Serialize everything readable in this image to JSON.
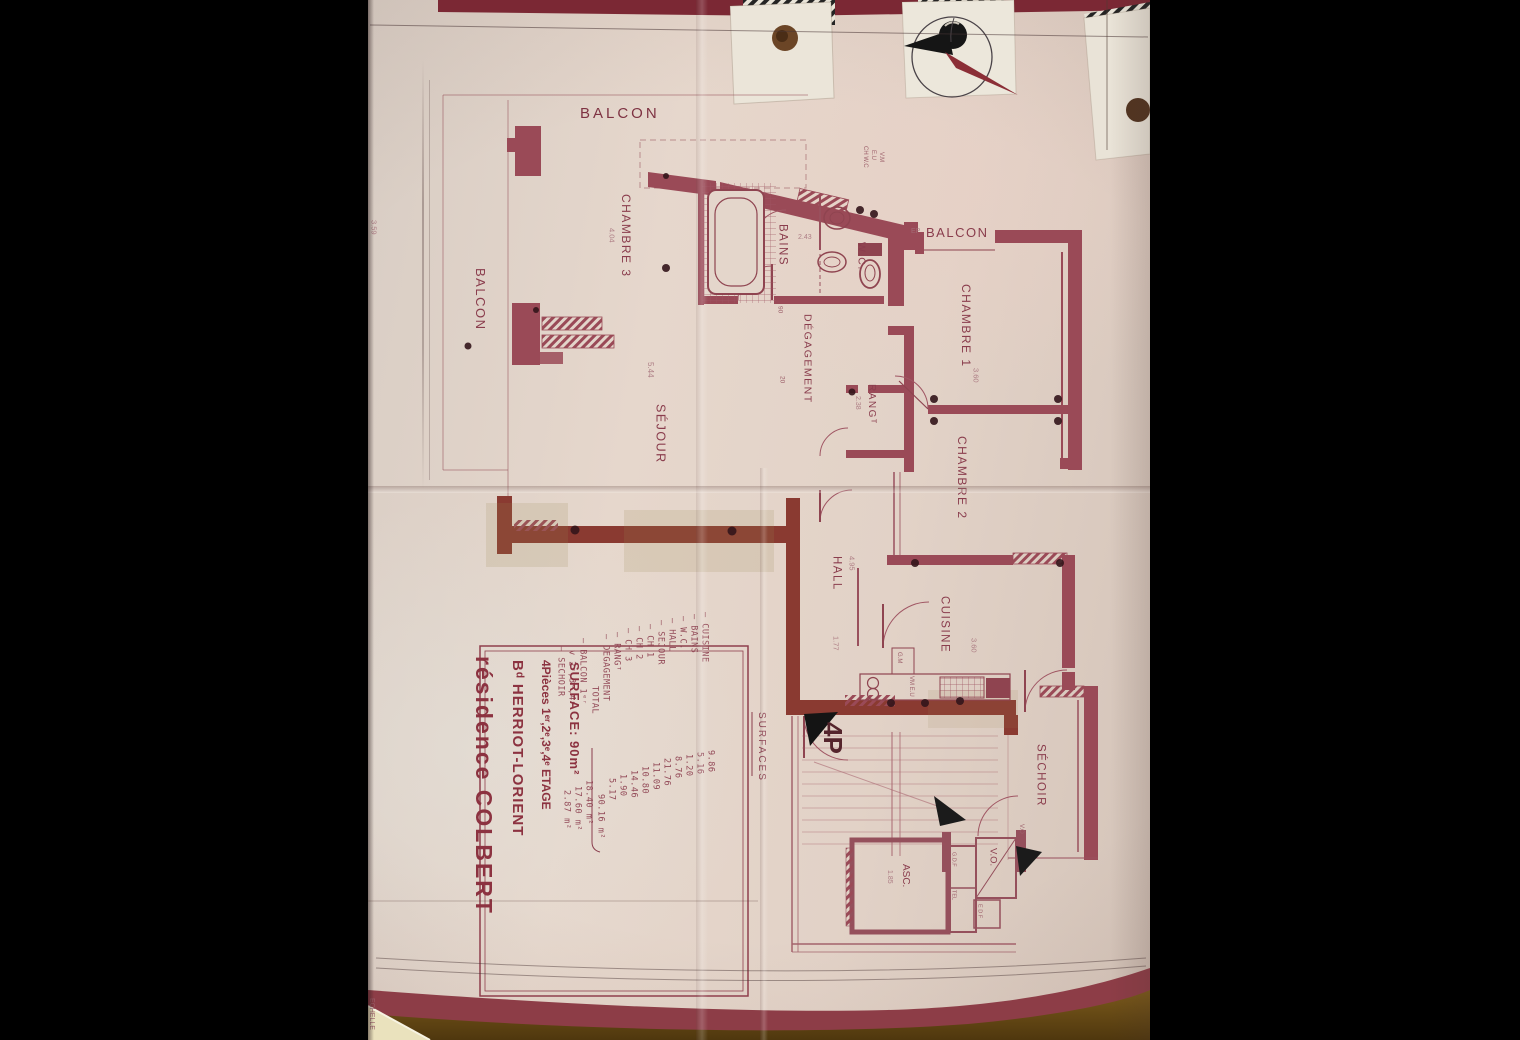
{
  "plan": {
    "rooms": {
      "balcon_top": "BALCON",
      "balcon_left": "BALCON",
      "chambre3": "CHAMBRE 3",
      "sejour": "SÉJOUR",
      "bains": "BAINS",
      "wc": "W.C.",
      "balcon_ep": "BALCON",
      "chambre1": "CHAMBRE 1",
      "degagement": "DÉGAGEMENT",
      "rang": "RANGᵀ",
      "chambre2": "CHAMBRE 2",
      "hall": "HALL",
      "cuisine": "CUISINE",
      "sechoir": "SÉCHOIR",
      "asc": "ASC.",
      "vo": "V.O."
    },
    "annotations": {
      "ep": "EP",
      "gm": "G.M",
      "vm_eu": "VM E.U",
      "ch_wc": "CH W.C",
      "eu": "E.U",
      "vm": "V.M",
      "vo_small": "V.O",
      "gdf": "G.D.F",
      "tel": "TEL",
      "edf": "E D F",
      "type_mark": "4P",
      "surfaces_axis": "SURFACES",
      "echelle": "ECHELLE"
    },
    "dimensions": {
      "chambre3": "4.04",
      "sejour": "5.44",
      "bains": "2.43",
      "chambre1": "3.60",
      "chambre2": "4.95",
      "hall": "1.77",
      "cuisine": "3.60",
      "rang": "2.38",
      "asc": "1.85",
      "margin_left": "3.59",
      "deg_w": "90",
      "deg_n": "20"
    },
    "title_block": {
      "line1": "résidence COLBERT",
      "line2": "Bᵈ HERRIOT-LORIENT",
      "line3": "4Pièces 1ᵉʳ,2ᵉ,3ᵉ,4ᵉ ETAGE",
      "line4": "SURFACE: 90m²"
    },
    "surfaces_table": {
      "header": "SURFACES",
      "rows": [
        {
          "label": "— CUISINE",
          "value": "9.86"
        },
        {
          "label": "— BAINS",
          "value": "5.16"
        },
        {
          "label": "— W.C.",
          "value": "1.20"
        },
        {
          "label": "— HALL",
          "value": "8.76"
        },
        {
          "label": "— SEJOUR",
          "value": "21.76"
        },
        {
          "label": "— CH 1",
          "value": "11.09"
        },
        {
          "label": "— CH 2",
          "value": "10.80"
        },
        {
          "label": "— CH 3",
          "value": "14.46"
        },
        {
          "label": "— RANGᵀ",
          "value": "1.90"
        },
        {
          "label": "— DEGAGEMENT",
          "value": "5.17"
        }
      ],
      "total": {
        "label": "TOTAL",
        "value": "90.16 m²"
      },
      "balcon1": {
        "label": "— BALCON 1ᵉʳ",
        "value": "18.40 m²"
      },
      "balcon2": {
        "label": "v 2ᵉ,3ᵉ,4ᵉ",
        "value": "17.60 m²"
      },
      "sechoir": {
        "label": "— SECHOIR",
        "value": "2.87 m²"
      }
    }
  }
}
